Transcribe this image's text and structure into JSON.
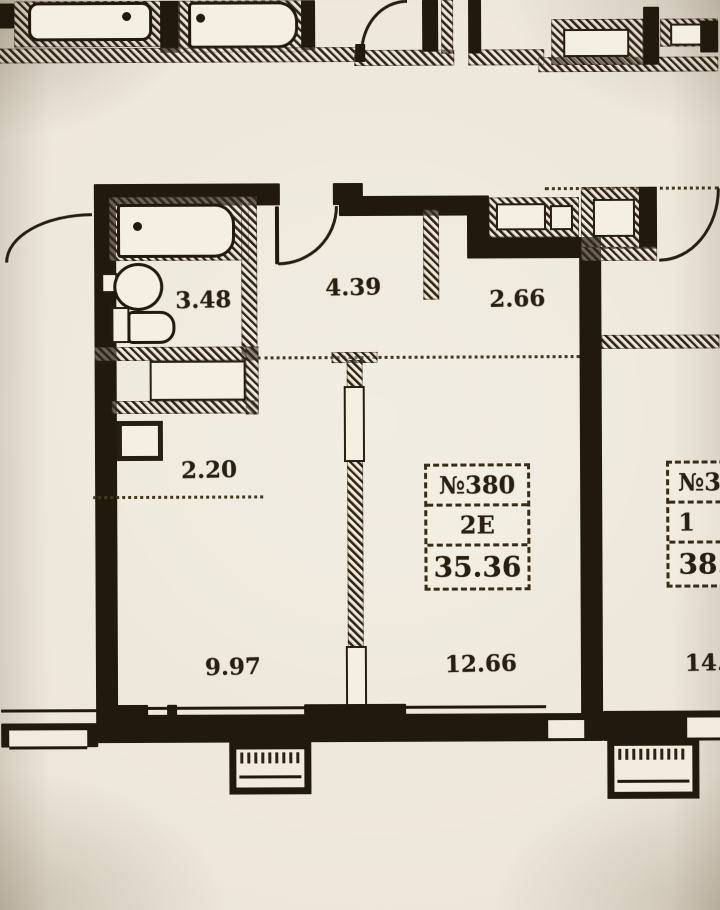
{
  "page": {
    "paper_color": "#ece5d7",
    "ink_color": "#241c11"
  },
  "plan": {
    "rooms": {
      "bathroom": "3.48",
      "hallway": "4.39",
      "entry_hall": "2.66",
      "corridor": "2.20",
      "bedroom": "9.97",
      "living_room": "12.66",
      "neighbor_room_partial": "14."
    },
    "unit_badge": {
      "number": "№380",
      "type": "2Е",
      "area": "35.36"
    },
    "neighbor_badge": {
      "number": "№3",
      "type": "1",
      "area": "38."
    }
  }
}
